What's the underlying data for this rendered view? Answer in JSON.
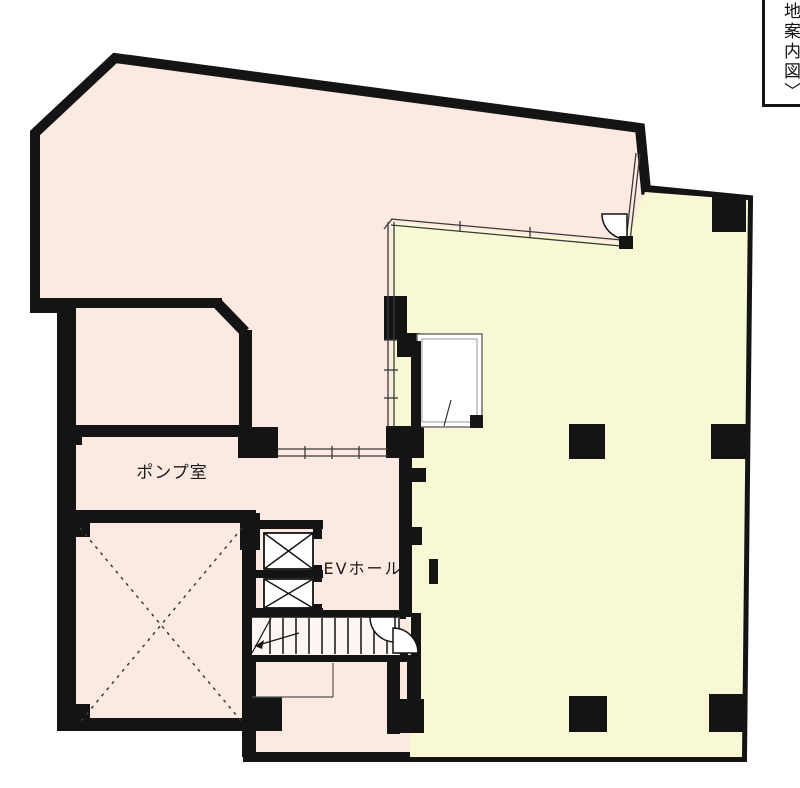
{
  "title": "building-floor-plan",
  "colors": {
    "background": "#ffffff",
    "wall": "#141414",
    "common_area_pink": "#fce9e1",
    "tenant_area_yellow": "#f8f8d4",
    "thin_line": "#3a3a3a",
    "highlight": "#e6ef75"
  },
  "rooms": {
    "pump_room": {
      "label": "ポンプ室"
    },
    "ev_hall": {
      "label": "EVホール"
    }
  },
  "map_link": {
    "label": "地案内図〉"
  },
  "features": {
    "elevators": 2,
    "stairs": 1,
    "void_x_marked_room": 1
  }
}
